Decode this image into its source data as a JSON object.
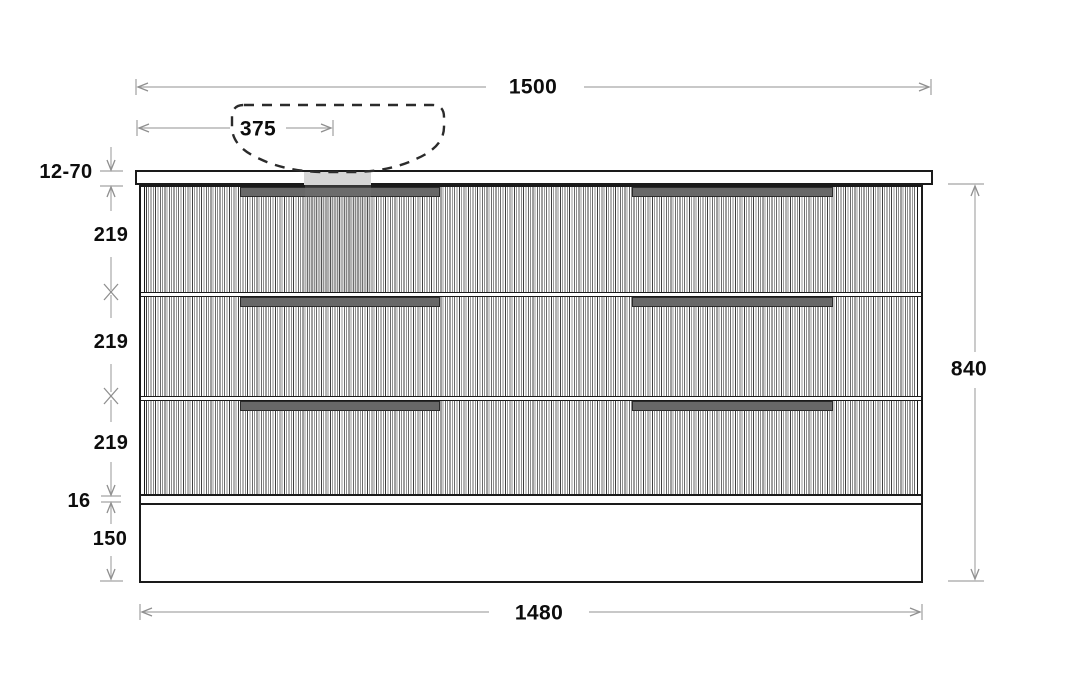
{
  "drawing": {
    "type": "vanity-cabinet-front-elevation",
    "dimensions": {
      "top_width": "1500",
      "basin_offset": "375",
      "benchtop_thickness": "12-70",
      "drawer_height_1": "219",
      "drawer_height_2": "219",
      "drawer_height_3": "219",
      "bottom_panel_gap": "16",
      "plinth_height": "150",
      "overall_height": "840",
      "cabinet_width": "1480"
    },
    "colors": {
      "outline": "#1a1a1a",
      "dimension_line": "#a8a8a8",
      "dimension_text": "#0d0d0d",
      "handle_fill": "#686868",
      "plumbing_shade": "#d6d6d6",
      "overlay_shade": "rgba(120,120,120,0.30)"
    }
  }
}
